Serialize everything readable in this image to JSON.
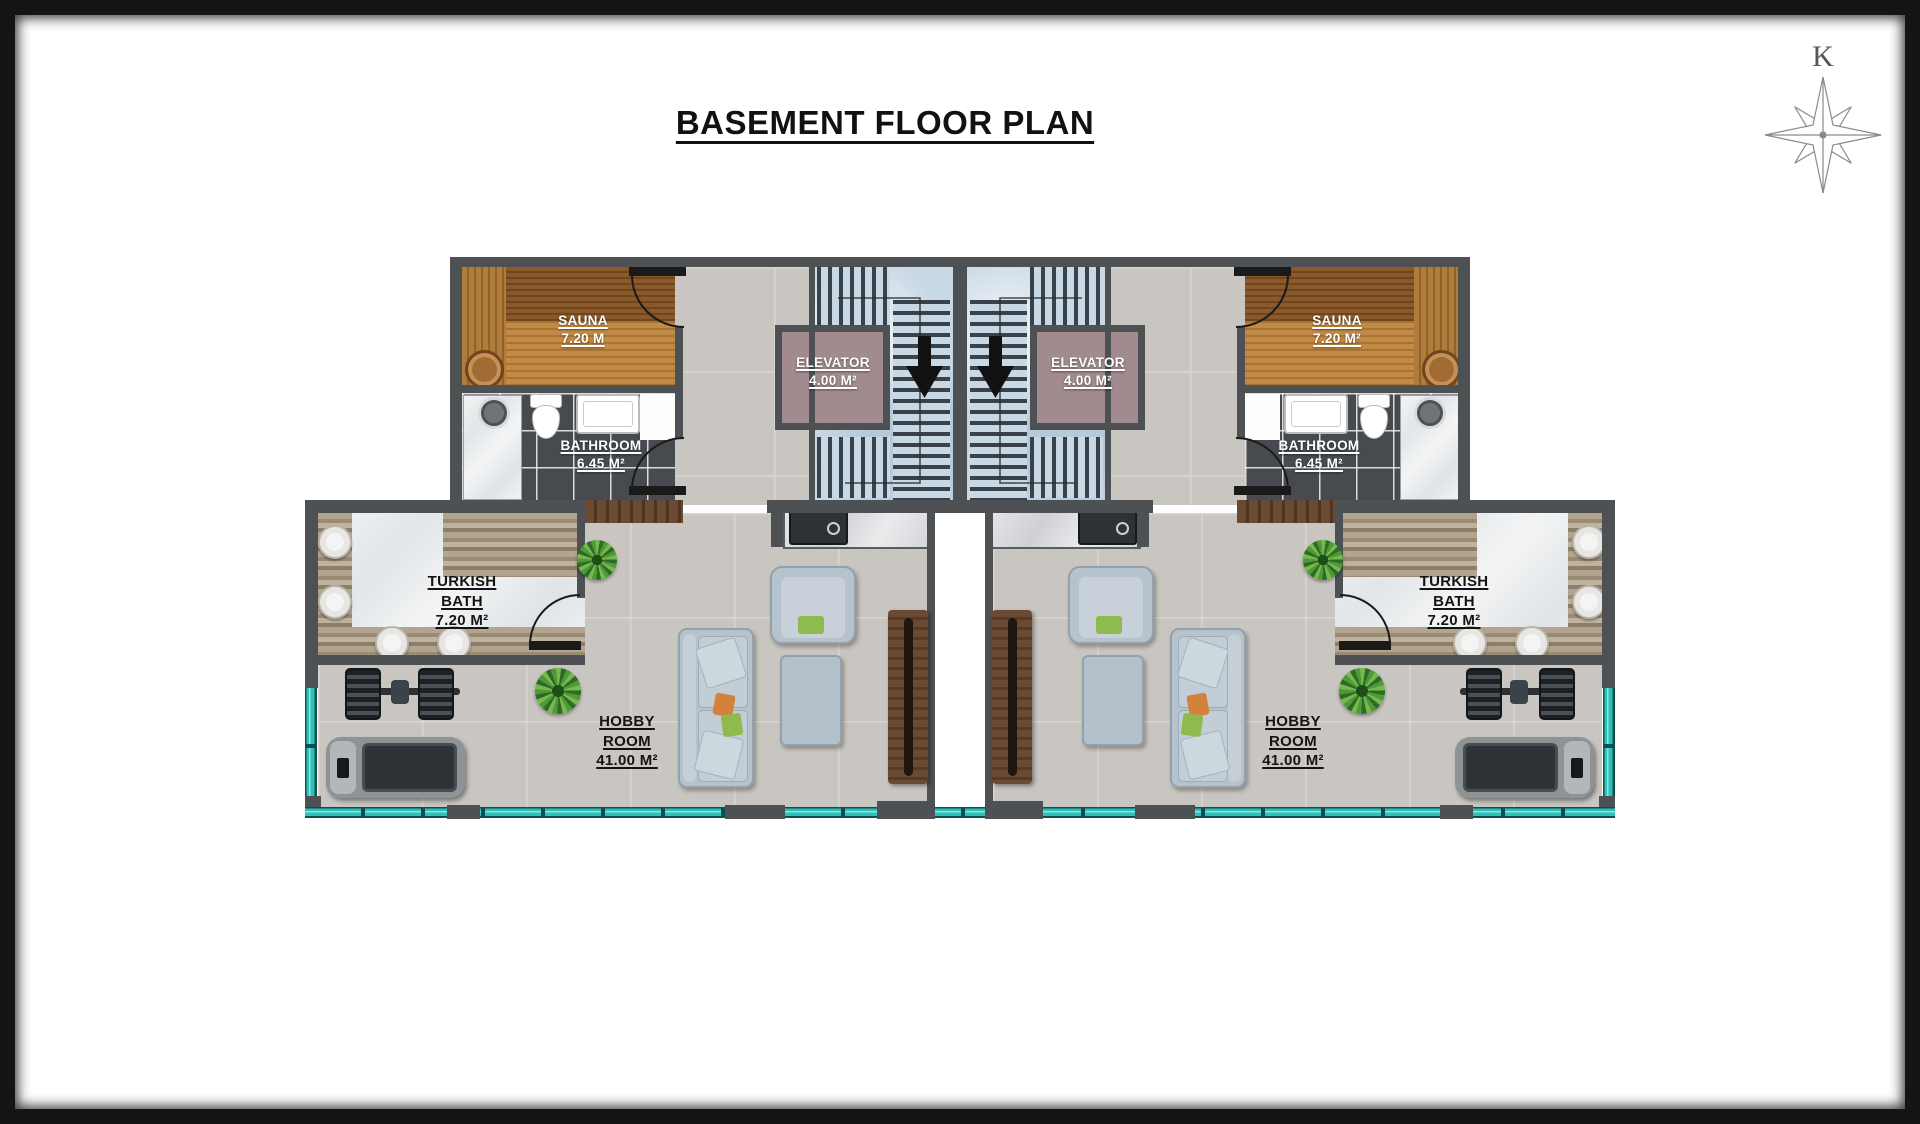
{
  "title": "BASEMENT FLOOR PLAN",
  "compass": {
    "label": "K"
  },
  "labels": {
    "sauna_left": {
      "line1": "SAUNA",
      "line2": "7.20 M",
      "line3": ""
    },
    "sauna_right": {
      "line1": "SAUNA",
      "line2": "7.20 M²",
      "line3": ""
    },
    "bathroom_left": {
      "line1": "BATHROOM",
      "line2": "6.45 M²",
      "line3": ""
    },
    "bathroom_right": {
      "line1": "BATHROOM",
      "line2": "6.45 M²",
      "line3": ""
    },
    "elevator_left": {
      "line1": "ELEVATOR",
      "line2": "4.00 M²",
      "line3": ""
    },
    "elevator_right": {
      "line1": "ELEVATOR",
      "line2": "4.00 M²",
      "line3": ""
    },
    "turkish_bath_left": {
      "line1": "TURKISH",
      "line2": "BATH",
      "line3": "7.20 M²"
    },
    "turkish_bath_right": {
      "line1": "TURKISH",
      "line2": "BATH",
      "line3": "7.20 M²"
    },
    "hobby_room_left": {
      "line1": "HOBBY",
      "line2": "ROOM",
      "line3": "41.00 M²"
    },
    "hobby_room_right": {
      "line1": "HOBBY",
      "line2": "ROOM",
      "line3": "41.00 M²"
    }
  },
  "icons": {
    "compass_rose": "8-point compass star",
    "stair_direction_glyph": "▼"
  },
  "colors": {
    "wall": "#4d5154",
    "floor_tile": "#c9c6c1",
    "window_teal": "#2fc0ba",
    "stair_marble": "#c9d8e5",
    "elevator_fill": "#a28b8f",
    "sauna_wood": "#c28a47",
    "bathroom_tile": "#474b4f",
    "travertine": "#a89a85",
    "frame": "#141414"
  }
}
